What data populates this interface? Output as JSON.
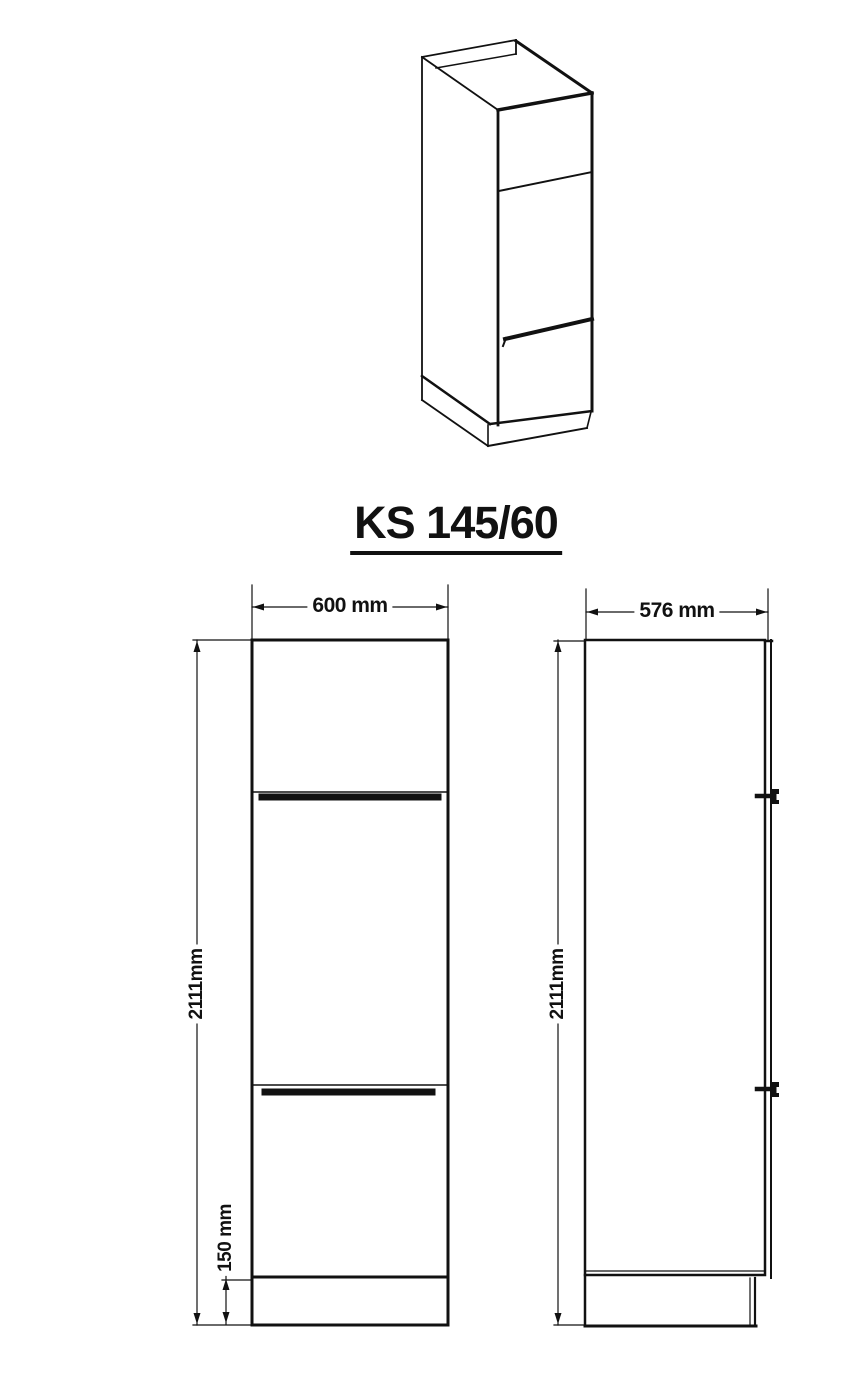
{
  "title": "KS 145/60",
  "drawing": {
    "front_view": {
      "width": "600 mm",
      "height": "2111mm",
      "plinth_height": "150 mm"
    },
    "side_view": {
      "depth": "576 mm",
      "height": "2111mm"
    }
  },
  "colors": {
    "line": "#111111",
    "background": "#ffffff"
  }
}
